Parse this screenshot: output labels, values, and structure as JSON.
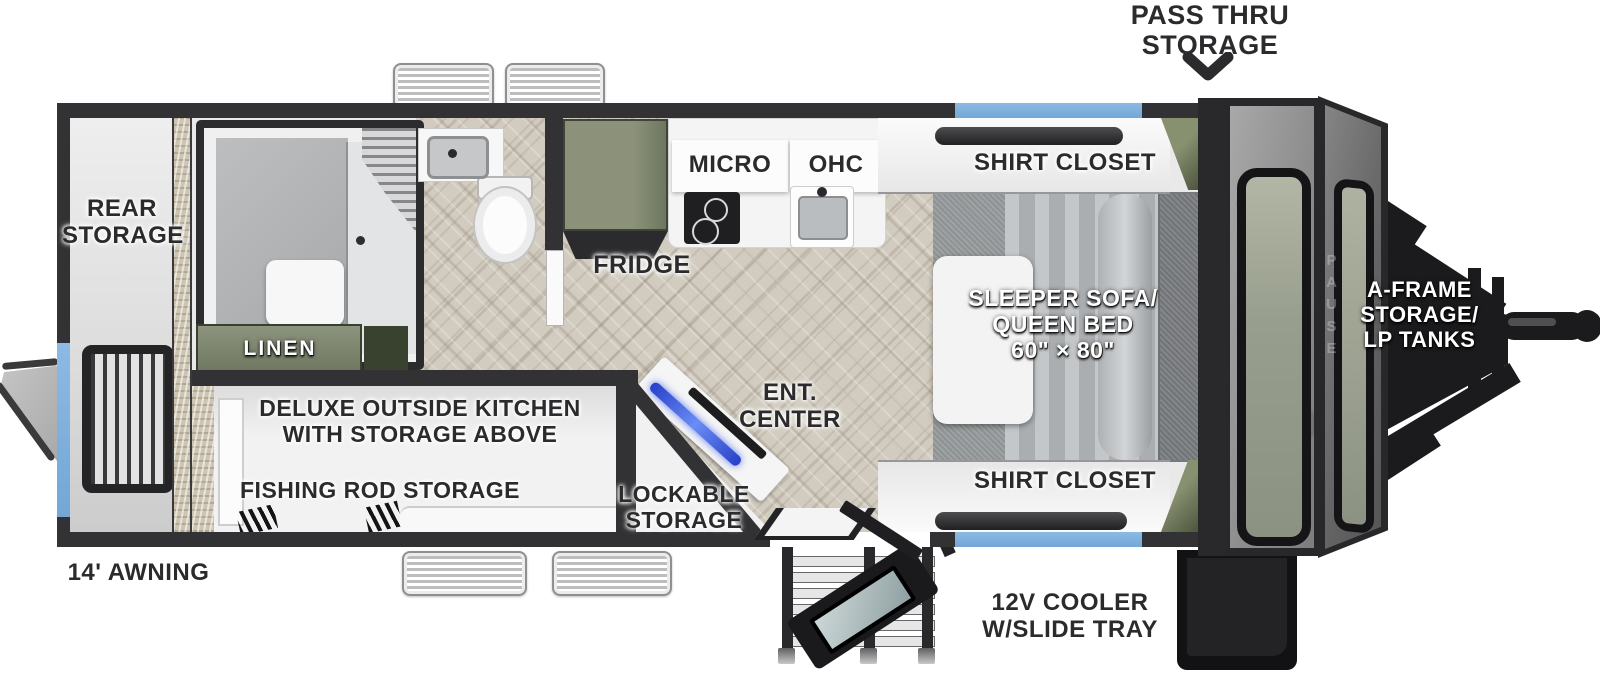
{
  "diagram": {
    "type": "travel-trailer floor plan",
    "exterior": {
      "pass_thru": "PASS THRU\nSTORAGE",
      "awning": "14' AWNING",
      "cooler": "12V COOLER\nW/SLIDE TRAY",
      "aframe": "A-FRAME\nSTORAGE/\nLP TANKS",
      "brand": "PAUSE"
    },
    "interior": {
      "rear_storage": "REAR\nSTORAGE",
      "linen": "LINEN",
      "micro": "MICRO",
      "ohc": "OHC",
      "fridge": "FRIDGE",
      "shirt_closet_top": "SHIRT CLOSET",
      "shirt_closet_bottom": "SHIRT CLOSET",
      "sleeper": "SLEEPER SOFA/\nQUEEN BED\n60\" × 80\"",
      "ent_center": "ENT.\nCENTER",
      "lockable": "LOCKABLE\nSTORAGE",
      "outside_kitchen": "DELUXE OUTSIDE KITCHEN\nWITH STORAGE ABOVE",
      "fishing_rod": "FISHING ROD STORAGE"
    },
    "colors": {
      "wall": "#323234",
      "window_blue": "#7fb1dd",
      "olive": "#87906f",
      "led_blue": "#4a6cf0",
      "floor_wood": "#d2ccc0",
      "text_dark": "#2b2b2d",
      "text_light": "#ffffff"
    }
  }
}
